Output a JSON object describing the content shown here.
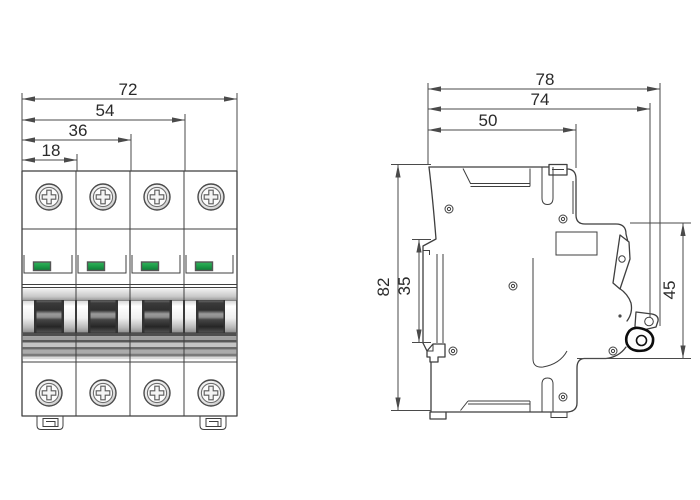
{
  "meta": {
    "drawing_type": "technical dimension drawing",
    "subject": "4-pole miniature circuit breaker (MCB), front and side elevation",
    "units": "mm"
  },
  "front_view": {
    "name": "front-view",
    "poles": 4,
    "width_dims": [
      {
        "label": "72"
      },
      {
        "label": "54"
      },
      {
        "label": "36"
      },
      {
        "label": "18"
      }
    ]
  },
  "side_view": {
    "name": "side-view",
    "width_dims": [
      {
        "label": "78"
      },
      {
        "label": "74"
      },
      {
        "label": "50"
      }
    ],
    "height_dims": [
      {
        "label": "82"
      },
      {
        "label": "35"
      },
      {
        "label": "45"
      }
    ]
  },
  "colors": {
    "line": "#3f3f3f",
    "dimension": "#4a4a4a",
    "text": "#2a2a2a",
    "led_green": "#1e9e4a",
    "led_green_dark": "#0e7a36",
    "handle_dark": "#2e2e2e"
  }
}
